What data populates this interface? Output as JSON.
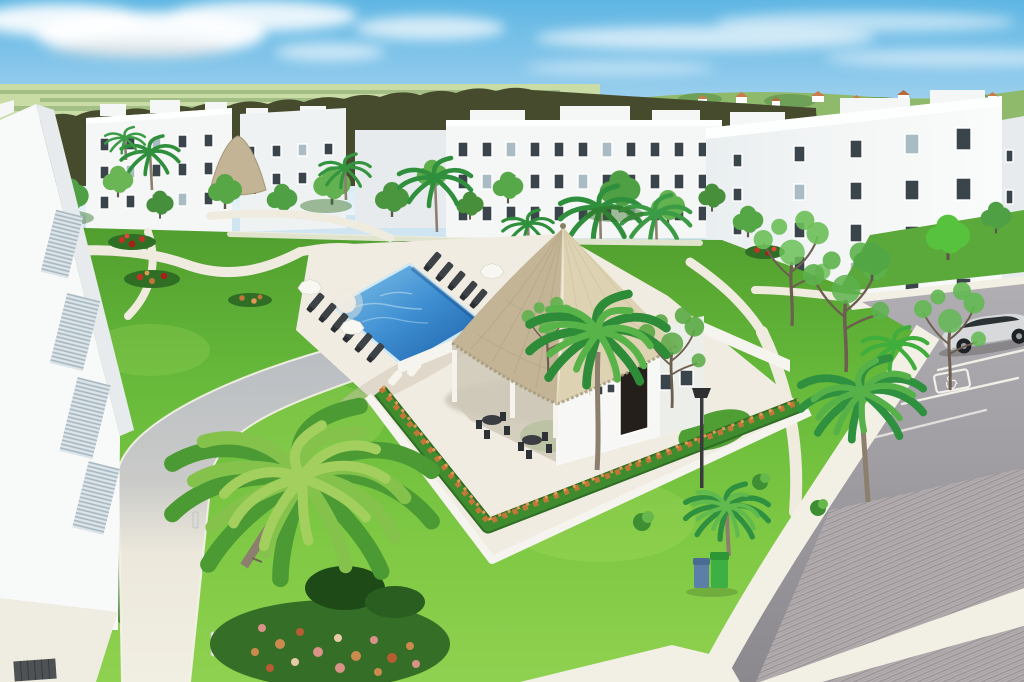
{
  "scene": {
    "description": "Aerial 3D architectural rendering of a white low-rise apartment complex around a landscaped courtyard: blue swimming pool with dark sun loungers and white umbrellas, a thatched-roof palapa clubhouse bordered by an orange flowering hedge, palm and shade trees, winding white walkways, a smaller palapa gazebo, and a curved road at the right with paver crosswalk, parking stalls, an accessible-parking pavement marking and a partially visible silver car.",
    "elements": [
      "sky-with-clouds",
      "distant-hills-and-rooftops",
      "dark-treeline",
      "white-apartment-buildings",
      "window-grids",
      "rooftop-parapets",
      "courtyard-lawn",
      "winding-walkways",
      "flower-beds",
      "swimming-pool",
      "pool-steps",
      "sun-loungers",
      "pool-umbrellas",
      "pool-deck",
      "thatched-palapa-clubhouse",
      "veranda-tables-and-chairs",
      "flowering-hedge-border",
      "white-garden-walls",
      "palapa-gazebo-small",
      "palm-trees",
      "shade-trees",
      "street-lamp",
      "trash-bin-blue",
      "trash-bin-green",
      "bollard-lights",
      "curved-road",
      "white-sidewalk",
      "paver-crosswalk",
      "parking-stall-lines",
      "accessible-parking-marking",
      "silver-car",
      "foreground-apartment-building",
      "louvered-facade",
      "plaza",
      "floor-grate"
    ]
  },
  "road_markings": {
    "parking_line_color": "#f0efe8",
    "accessible_parking_icon": "wheelchair-symbol"
  },
  "objects": {
    "bins": [
      "blue",
      "green"
    ],
    "car": "silver"
  },
  "palette": {
    "sky_top": "#5fb6e3",
    "sky_mid": "#8fcaec",
    "sky_low": "#e9f4f8",
    "cloud": "#ffffff",
    "field": "#c9dca6",
    "hills": "#8fb96b",
    "treeline": "#474b2e",
    "building_white": "#f5f7f7",
    "building_shade": "#e7ebee",
    "window_dark": "#3a444b",
    "window_light": "#a9bcc4",
    "grass_top": "#4f9c2e",
    "grass_mid": "#66b93a",
    "grass_low": "#8fd150",
    "grass_shadow": "#245c1c",
    "path": "#efebdf",
    "path_shade": "#b9bdc2",
    "deck": "#f0ece1",
    "sidewalk": "#f2efe5",
    "pool_light": "#86c6ea",
    "pool_mid": "#3f8fd2",
    "pool_deep": "#1c5ea8",
    "waterline": "#cfe9f4",
    "thatch_light": "#ddd2b2",
    "thatch_dark": "#c2b494",
    "thatch_edge": "#a5997a",
    "hedge_green": "#3e8c2d",
    "hedge_green_dark": "#2f6e24",
    "hedge_flower": "#c4763a",
    "hedge_flower_light": "#e09a55",
    "flower_red": "#c53125",
    "flower_pink": "#d99287",
    "lounger": "#3d4247",
    "umbrella": "#f8f7f2",
    "wall_white": "#f6f4ee",
    "road": "#a2a1a6",
    "paver": "#b4aeb0",
    "paver_stripe": "#958f91",
    "marking_white": "#f0efe8",
    "car_body": "#d7d9da",
    "car_glass": "#2c3134",
    "wheel": "#1f2224",
    "bin_blue": "#5b7fa7",
    "bin_green": "#3cb043",
    "trunk": "#8d7f6d",
    "trunk_dark": "#5f564a",
    "palm_dark": "#2f8f3c",
    "palm_mid": "#4c9a33",
    "palm_light": "#84c24c",
    "tree_green": "#4f9f45",
    "tree_light": "#6ab654",
    "tree_bright": "#57c23e",
    "lamp": "#3a3a3c",
    "grate": "#4e5254",
    "louver_base": "#dce5e9",
    "louver_line": "#a6b6bf"
  }
}
